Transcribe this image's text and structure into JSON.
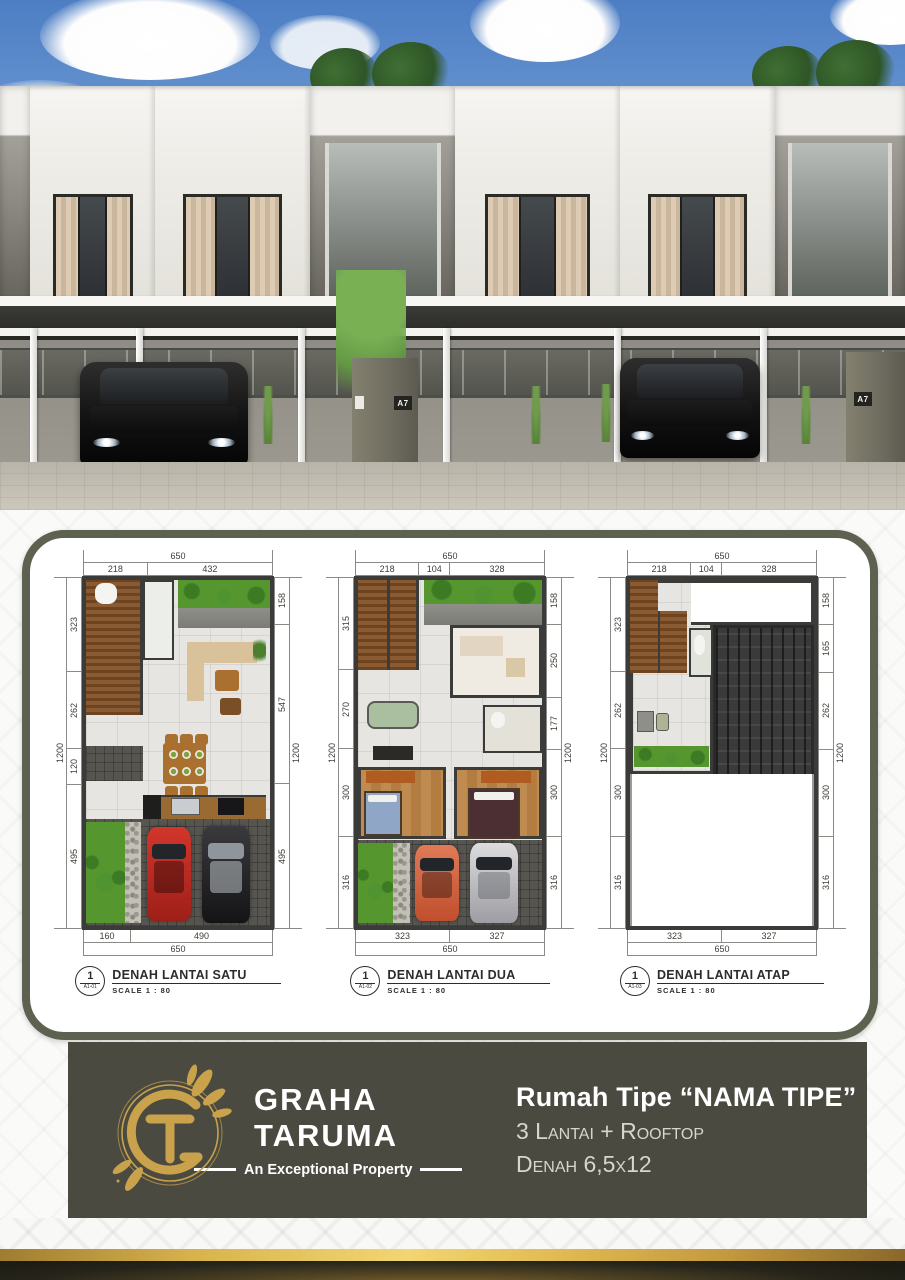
{
  "hero": {
    "unit_plaque": "A7",
    "scene": "3d-render-townhouse-row"
  },
  "plans_card": {
    "border_color": "#5d6150",
    "plans": [
      {
        "circle_number": "1",
        "circle_sub": "A1-01",
        "title": "DENAH LANTAI SATU",
        "scale": "SCALE 1 : 80",
        "dims": {
          "top_total": "650",
          "top": [
            "218",
            "432"
          ],
          "left_total": "1200",
          "left": [
            "323",
            "262",
            "120",
            "495"
          ],
          "right": [
            "158",
            "547",
            "495"
          ],
          "right_total": "1200",
          "bottom": [
            "160",
            "490"
          ],
          "bottom_total": "650"
        }
      },
      {
        "circle_number": "1",
        "circle_sub": "A1-02",
        "title": "DENAH LANTAI DUA",
        "scale": "SCALE 1 : 80",
        "dims": {
          "top_total": "650",
          "top": [
            "218",
            "104",
            "328"
          ],
          "left_total": "1200",
          "left": [
            "315",
            "270",
            "300",
            "316"
          ],
          "right": [
            "158",
            "250",
            "177",
            "300",
            "316"
          ],
          "right_total": "1200",
          "bottom": [
            "323",
            "327"
          ],
          "bottom_total": "650"
        }
      },
      {
        "circle_number": "1",
        "circle_sub": "A1-03",
        "title": "DENAH LANTAI ATAP",
        "scale": "SCALE 1 : 80",
        "dims": {
          "top_total": "650",
          "top": [
            "218",
            "104",
            "328"
          ],
          "left_total": "1200",
          "left": [
            "323",
            "262",
            "300",
            "316"
          ],
          "right": [
            "158",
            "165",
            "262",
            "300",
            "316"
          ],
          "right_total": "1200",
          "bottom": [
            "323",
            "327"
          ],
          "bottom_total": "650"
        }
      }
    ]
  },
  "brand": {
    "monogram": "GT",
    "name_line1": "GRAHA",
    "name_line2": "TARUMA",
    "tagline": "An Exceptional Property",
    "panel_color": "#4a4a41",
    "gold_color": "#c9a24b"
  },
  "info": {
    "title": "Rumah Tipe “NAMA TIPE”",
    "line2": "3 Lantai + Rooftop",
    "line3": "Denah 6,5x12"
  }
}
